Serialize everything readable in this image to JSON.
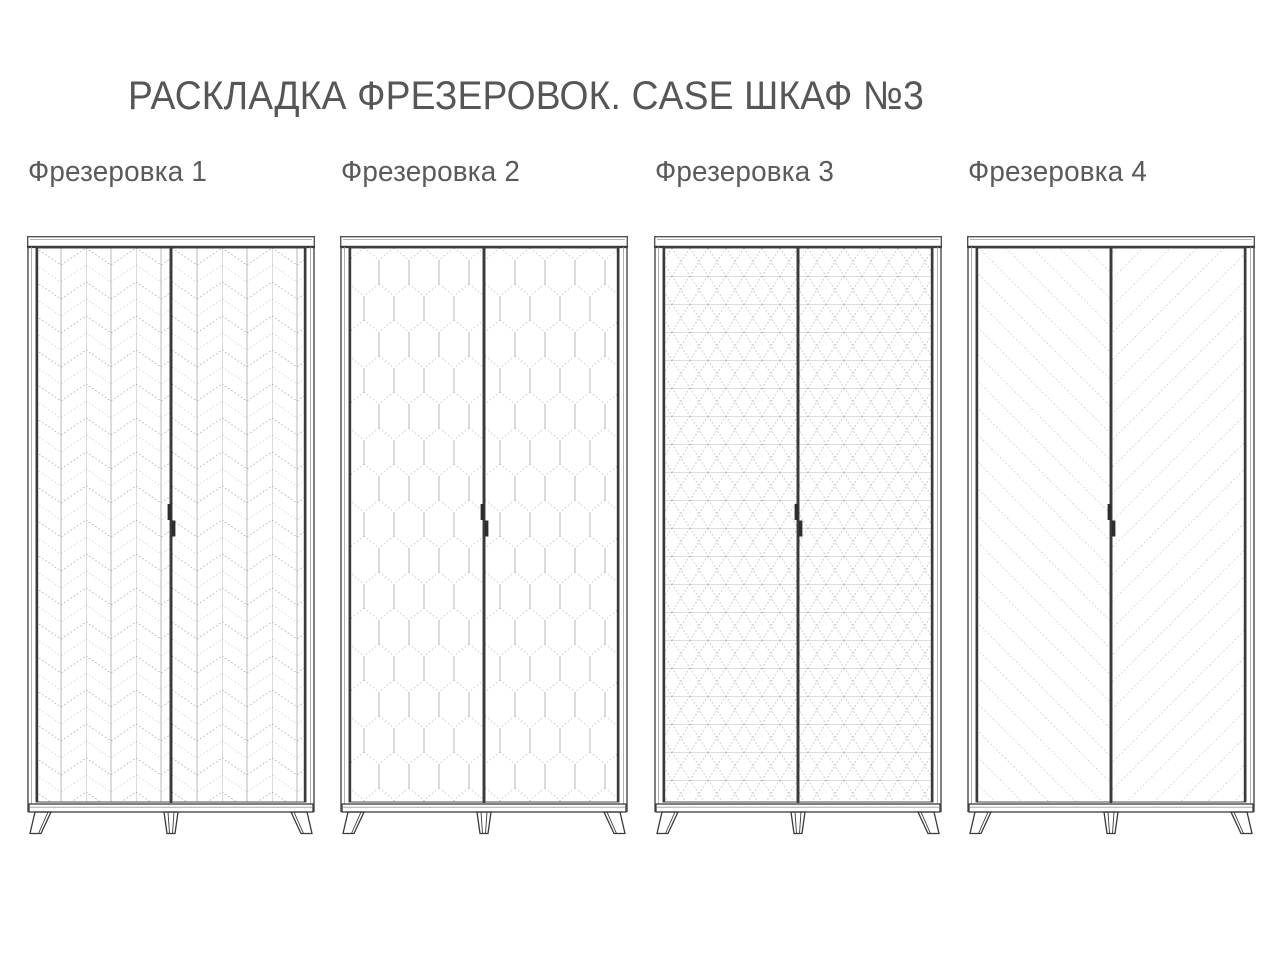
{
  "title": "РАСКЛАДКА ФРЕЗЕРОВОК. CASE ШКАФ №3",
  "cabinets": [
    {
      "label": "Фрезеровка 1",
      "pattern": "herringbone-columns"
    },
    {
      "label": "Фрезеровка 2",
      "pattern": "honeycomb-hexagons"
    },
    {
      "label": "Фрезеровка 3",
      "pattern": "isometric-cubes"
    },
    {
      "label": "Фрезеровка 4",
      "pattern": "diagonal-chevron"
    }
  ],
  "colors": {
    "text": "#5a5a5c",
    "outline_dark": "#3a3a3a",
    "outline_mid": "#4a4a4a",
    "hairline": "#9a9a9a",
    "pattern_dark": "#b3b3b3",
    "pattern_light": "#d6d6d6",
    "pattern_solid": "#a6a6a6",
    "background": "#ffffff"
  }
}
